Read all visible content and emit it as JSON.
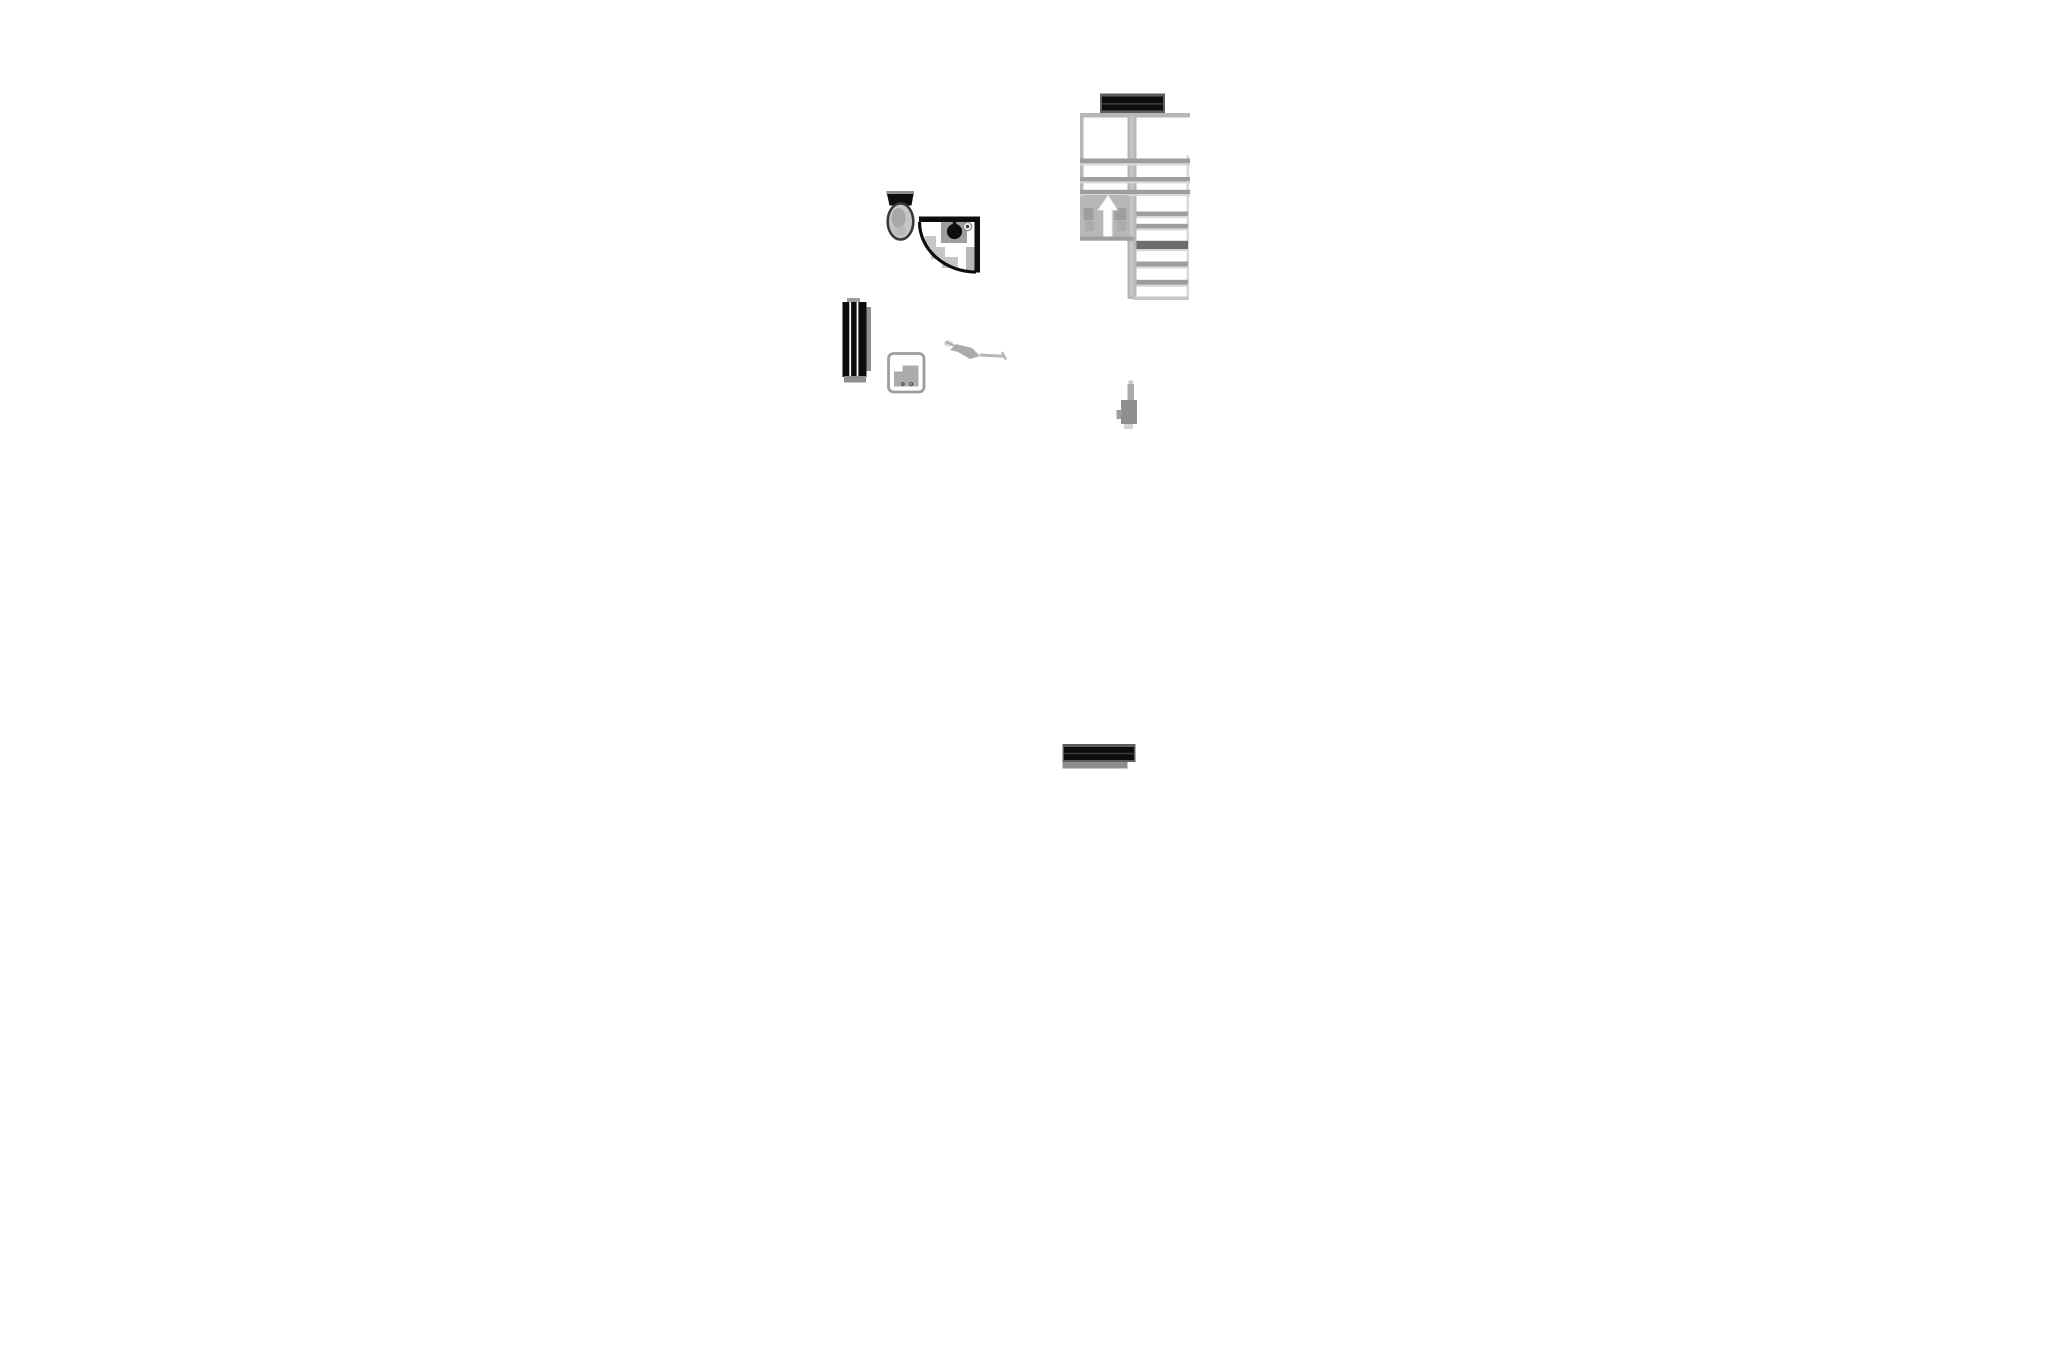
{
  "page": {
    "background": "#ffffff",
    "canvas_label": "architectural floor plan fragment"
  },
  "colors": {
    "ink": "#0d0d0d",
    "charcoal": "#3a3a3a",
    "steel": "#5f5f5f",
    "shadow": "#6d6d6d",
    "smoke": "#8f8f8f",
    "ash": "#9e9e9e",
    "stone": "#ababab",
    "silver": "#b7b7b7",
    "mist": "#c6c6c6",
    "fog": "#d8d8d8",
    "cloud": "#e9e9e9",
    "white": "#ffffff"
  },
  "icons": {
    "stair_direction": "arrow-up",
    "shower_head": "sprinkler"
  },
  "fixtures": {
    "wall_top": {
      "label": "wall segment"
    },
    "staircase": {
      "label": "staircase with up direction arrow"
    },
    "toilet": {
      "label": "toilet"
    },
    "shower": {
      "label": "corner shower enclosure"
    },
    "radiator": {
      "label": "radiator"
    },
    "basin": {
      "label": "washbasin"
    },
    "faucet": {
      "label": "faucet fitting"
    },
    "valve": {
      "label": "pipe valve fitting"
    },
    "wall_bottom": {
      "label": "wall segment"
    }
  }
}
